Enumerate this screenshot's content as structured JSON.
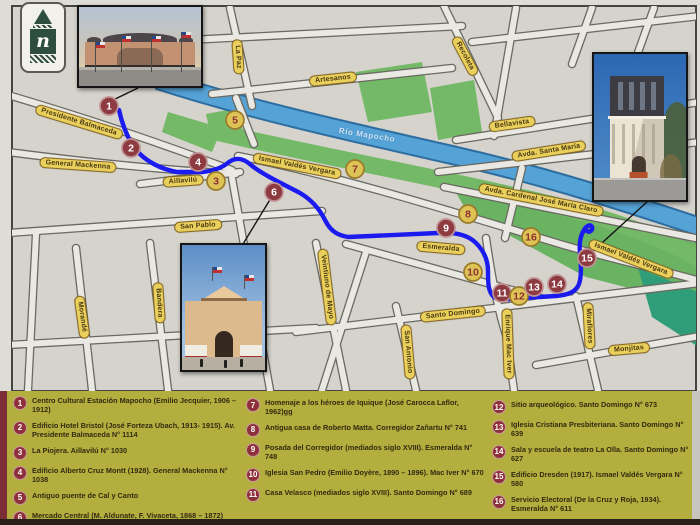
{
  "map": {
    "logo_letter": "n",
    "river_label": "Río Mapocho",
    "streets": {
      "presidente_balmaceda": "Presidente Balmaceda",
      "general_mackenna": "General Mackenna",
      "aillavilu": "Aillavilú",
      "san_pablo": "San Pablo",
      "la_paz": "La Paz",
      "artesanos": "Artesanos",
      "recoleta": "Recoleta",
      "bellavista": "Bellavista",
      "avda_santa_maria": "Avda. Santa María",
      "avda_cardenal": "Avda. Cardenal José María Claro",
      "ismael_valdes_vergara_west": "Ismael Valdés Vergara",
      "ismael_valdes_vergara_east": "Ismael Valdés Vergara",
      "esmeralda": "Esmeralda",
      "santo_domingo": "Santo Domingo",
      "veintiuno_de_mayo": "Veintiuno de Mayo",
      "san_antonio": "San Antonio",
      "enrique_mac_iver": "Enrique Mac Iver",
      "miraflores": "Miraflores",
      "monjitas": "Monjitas",
      "morande": "Morandé",
      "bandera": "Bandera"
    },
    "marker_numbers": [
      "1",
      "2",
      "3",
      "4",
      "5",
      "6",
      "7",
      "8",
      "9",
      "10",
      "11",
      "12",
      "13",
      "14",
      "15",
      "16"
    ]
  },
  "legend": {
    "items": [
      {
        "num": "1",
        "text": "Centro Cultural Estación Mapocho (Emilio Jecquier, 1906 – 1912)"
      },
      {
        "num": "2",
        "text": "Edificio Hotel Bristol (José Forteza Ubach, 1913- 1915). Av. Presidente Balmaceda N° 1114"
      },
      {
        "num": "3",
        "text": "La Piojera. Aillavilú N° 1030"
      },
      {
        "num": "4",
        "text": "Edificio Alberto Cruz Montt (1928). General Mackenna N° 1038"
      },
      {
        "num": "5",
        "text": "Antiguo puente de Cal y Canto"
      },
      {
        "num": "6",
        "text": "Mercado Central (M. Aldunate, F. Vivaceta, 1868 – 1872)"
      },
      {
        "num": "7",
        "text": "Homenaje a los héroes de Iquique (José Carocca Laflor, 1962)gg"
      },
      {
        "num": "8",
        "text": "Antigua casa de Roberto Matta. Corregidor Zañartu N° 741"
      },
      {
        "num": "9",
        "text": "Posada del Corregidor (mediados siglo XVIII). Esmeralda N° 748"
      },
      {
        "num": "10",
        "text": "Iglesia San Pedro (Emilio Doyère, 1890 – 1896). Mac Iver N° 670"
      },
      {
        "num": "11",
        "text": "Casa Velasco (mediados siglo XVIII). Santo Domingo N° 689"
      },
      {
        "num": "12",
        "text": "Sitio arqueológico. Santo Domingo N° 673"
      },
      {
        "num": "13",
        "text": "Iglesia Cristiana Presbiteriana. Santo Domingo N° 639"
      },
      {
        "num": "14",
        "text": "Sala y escuela de teatro La Olla. Santo Domingo N° 627"
      },
      {
        "num": "15",
        "text": "Edificio Dresden (1917). Ismael Valdés Vergara N° 580"
      },
      {
        "num": "16",
        "text": "Servicio Electoral (De la Cruz y Roja, 1934). Esmeralda N° 611"
      }
    ]
  },
  "colors": {
    "route_blue": "#1b1bf0",
    "river_blue": "#55a2d6",
    "park_green": "#74b967",
    "label_yellow": "#e9d05c",
    "marker_maroon": "#8d3a40",
    "marker_yellow": "#ddc355",
    "legend_olive": "#b3ae3e"
  }
}
